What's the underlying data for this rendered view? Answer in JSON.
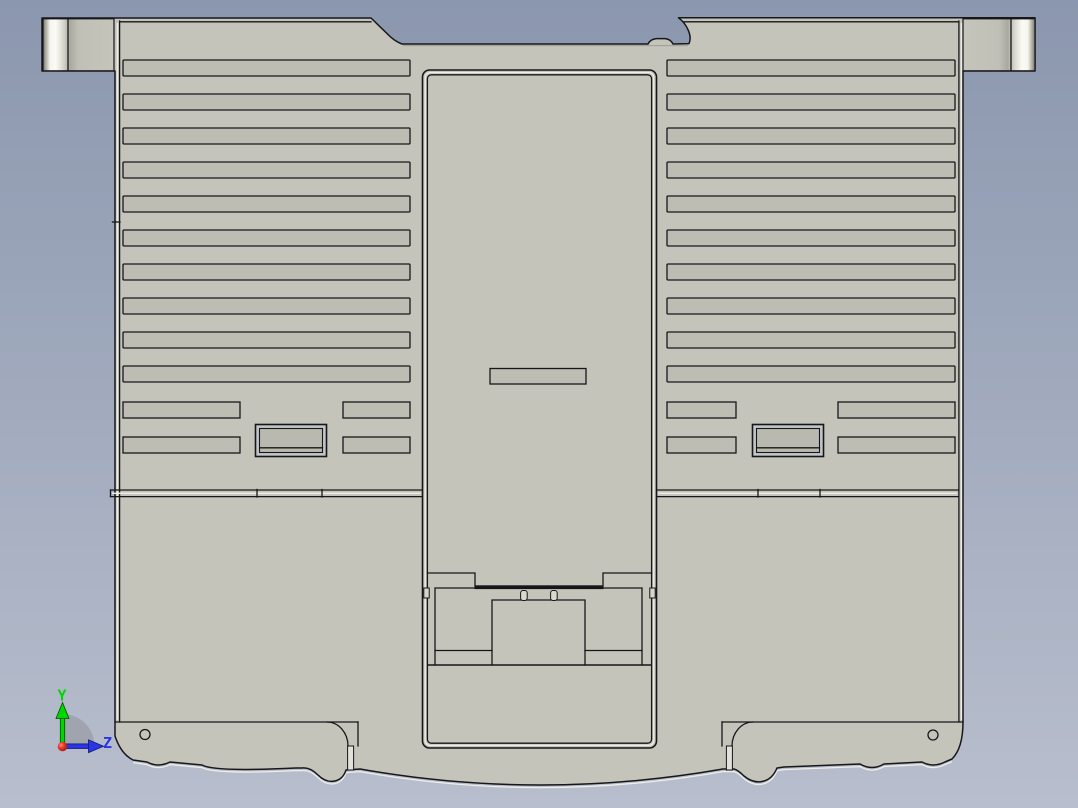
{
  "viewport": {
    "background_top": "#8b97ae",
    "background_bottom": "#b8becd",
    "part_color": "#c4c4bb",
    "slot_color": "#bdbdb4",
    "edge_color": "#17171a",
    "highlight_color": "#eeeee8"
  },
  "orientation_triad": {
    "y_axis_label": "Y",
    "y_axis_color": "#00d600",
    "z_axis_label": "Z",
    "z_axis_color": "#2a35e6",
    "origin_color": "#d81818",
    "arc_color": "#989ca4"
  }
}
